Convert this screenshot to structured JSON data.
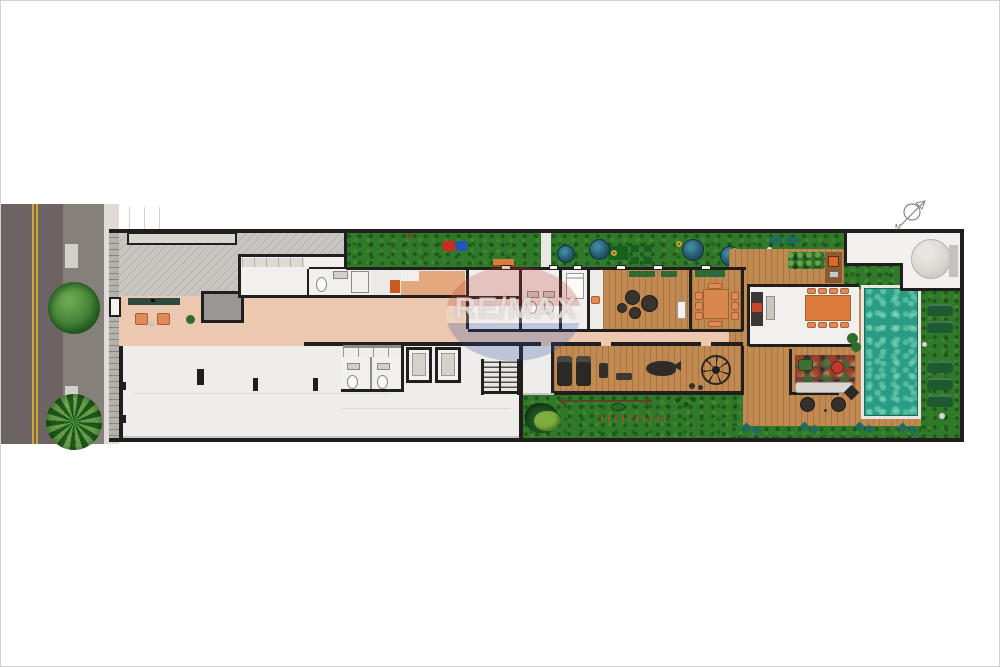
{
  "watermark": {
    "brand": "RE/MAX"
  },
  "compass": {
    "label": "N"
  },
  "colors": {
    "asphalt": "#6b6462",
    "road_lane": "#86807b",
    "lane_marking": "#d2a62e",
    "sidewalk": "#dfdcd8",
    "fence": "#b5b1ad",
    "wall": "#211f1d",
    "driveway": "#c9c5c1",
    "garage_floor": "#efedeb",
    "floor_white": "#f2f0ee",
    "floor_gray": "#9b9795",
    "corridor_salmon": "#ecc8b0",
    "suite_orange": "#e3a87e",
    "lawn": "#30782a",
    "tree": "#3f7d35",
    "ornamental_tree": "#235668",
    "wood": "#c18a52",
    "pool": "#2b9c84",
    "mat_red": "#cf2a20",
    "mat_blue": "#2353c0",
    "accent_orange": "#dd7b3c",
    "chair_orange": "#e2895c",
    "lounger_green": "#1d5a2f",
    "bench_teal": "#1f6b61",
    "tank_gray": "#d8d5d1",
    "watermark_red": "#bb3a31",
    "watermark_blue": "#2c4ba0"
  },
  "features": {
    "names": [
      "street",
      "street-trees",
      "sidewalk",
      "driveway",
      "reception-lobby",
      "offices",
      "restrooms",
      "storage-room",
      "garage-hall",
      "changing-rooms",
      "elevators",
      "stairs",
      "garden",
      "play-mats",
      "ornamental-trees",
      "gym",
      "playroom",
      "massage-room",
      "pouf-lounge",
      "dining-room",
      "gourmet-kitchen",
      "bbq-deck",
      "living-lounge",
      "wood-deck",
      "swimming-pool",
      "sun-loungers",
      "water-tank",
      "utility-area",
      "play-lawn"
    ]
  }
}
